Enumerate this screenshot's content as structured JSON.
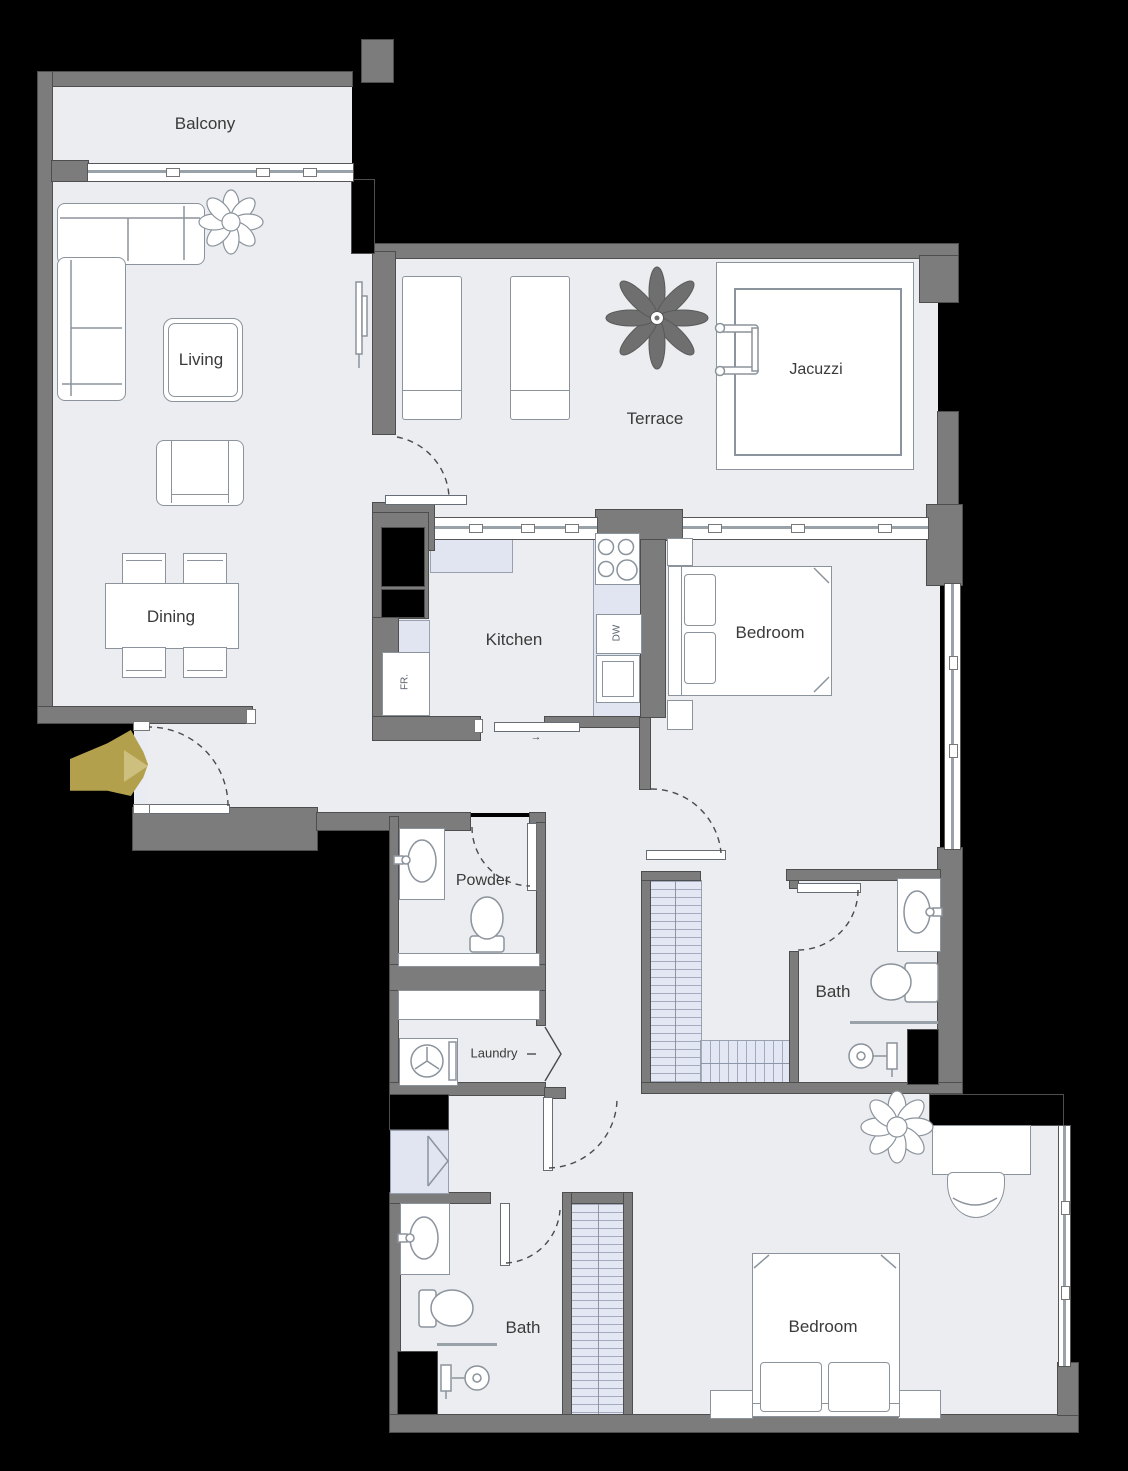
{
  "plan": {
    "rooms": {
      "balcony": "Balcony",
      "living": "Living",
      "dining": "Dining",
      "terrace": "Terrace",
      "jacuzzi": "Jacuzzi",
      "kitchen": "Kitchen",
      "bedroom1": "Bedroom",
      "powder": "Powder",
      "laundry": "Laundry",
      "bath1": "Bath",
      "bath2": "Bath",
      "bedroom2": "Bedroom"
    },
    "appliances": {
      "fridge": "FR.",
      "dishwasher": "DW"
    },
    "annotations": {
      "kitchen_door_arrow": "→"
    },
    "colors": {
      "background": "#000000",
      "wall": "#7c7c7c",
      "wall_outline": "#4e4e4e",
      "floor": "#ebedf0",
      "furniture_outline": "#8b939c",
      "counter": "#e1e5f1",
      "wardrobe": "#e3e7f3",
      "entry_arrow": "#b3a04c",
      "entry_arrow_light": "#cdc07e",
      "label": "#3a3a3a",
      "terrace_plant": "#6f6f6f"
    }
  }
}
